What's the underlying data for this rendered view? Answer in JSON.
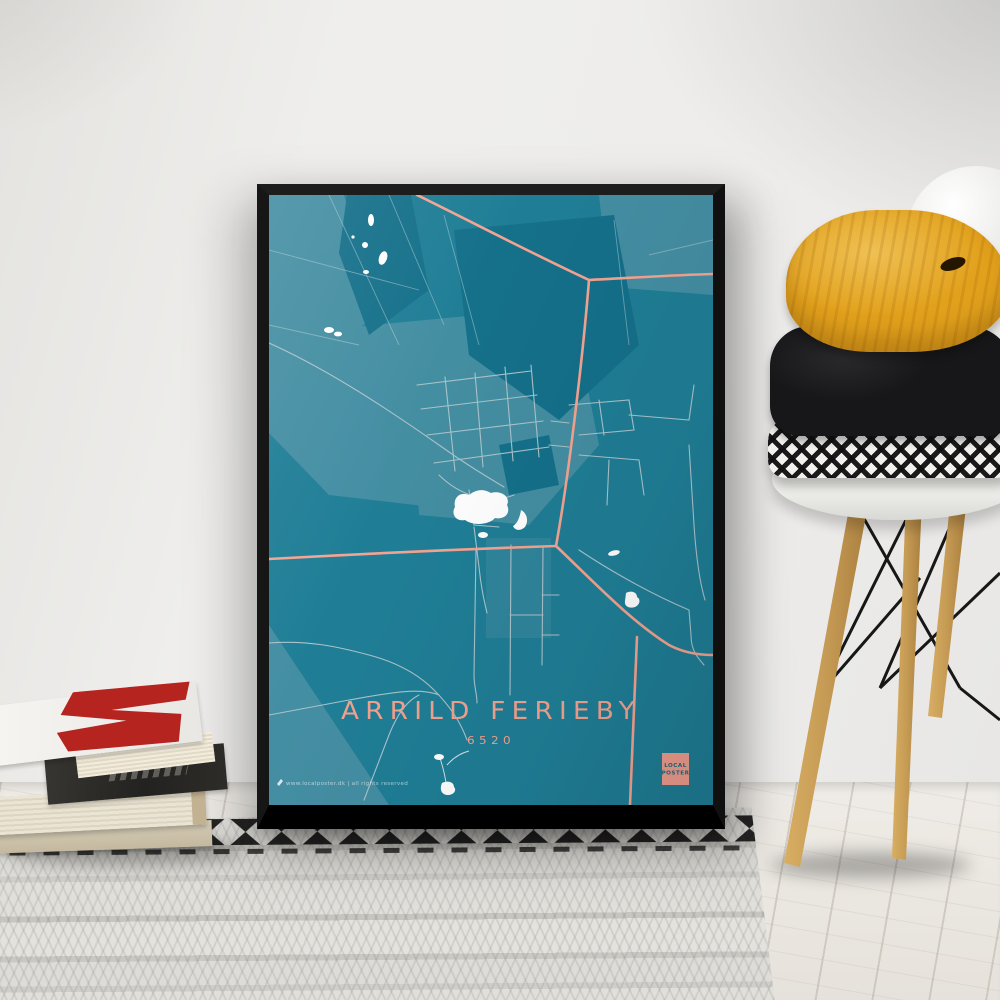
{
  "poster": {
    "title": "ARRILD FERIEBY",
    "postal_code": "6520",
    "footer_url": "www.localposter.dk | all rights reserved",
    "logo": {
      "line1": "LOCAL",
      "line2": "POSTER"
    },
    "colors": {
      "map_background": "#1F7E96",
      "field_light": "#4E93A6",
      "field_dark": "#166F88",
      "minor_road": "#A9C3CB",
      "major_road": "#F3A491",
      "water": "#FFFFFF",
      "title_text": "#F3A28F",
      "frame": "#141414"
    }
  },
  "scene": {
    "wall_color": "#ECEBE9",
    "floor_color": "#E9E6E1",
    "rug_color": "#D8D7D2",
    "sweater_top_color": "#E2A11C",
    "sweater_middle_color": "#17171A",
    "sweater_bottom_colors": "#F2F1EE/#161616",
    "stool_leg_color": "#C59A54"
  }
}
